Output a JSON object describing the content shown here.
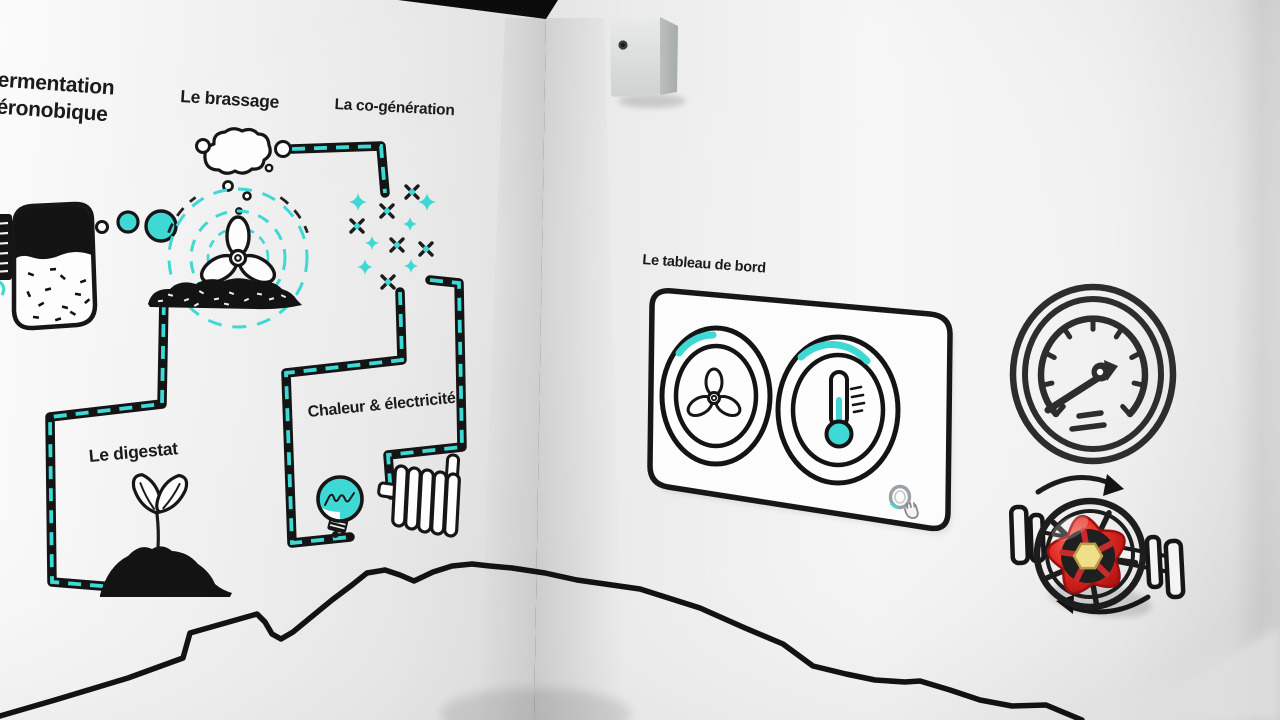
{
  "colors": {
    "accent": "#3ed8d5",
    "ink": "#1b1b1b",
    "valve-red": "#d42222",
    "valve-red-dark": "#9b0f0f",
    "valve-yellow": "#f1de8b",
    "panel-fill": "#fcfcfc",
    "hint-gray": "#9aa0a3"
  },
  "mural": {
    "title_line1": "fermentation",
    "title_line2": "aéronobique",
    "brewing_label": "Le brassage",
    "cogeneration_label": "La co-génération",
    "digestate_label": "Le digestat",
    "heat_electricity_label": "Chaleur & électricité"
  },
  "dashboard": {
    "title": "Le tableau de bord",
    "dials": [
      {
        "name": "fan-dial",
        "icon": "fan-icon",
        "level_indicator": "teal-arc"
      },
      {
        "name": "temperature-dial",
        "icon": "thermometer-icon",
        "level_indicator": "teal-arc"
      }
    ],
    "hint_icon": "magnifier-hand-icon"
  },
  "right_wall_props": {
    "gauge_icon": "pressure-gauge-icon",
    "valve_icon": "valve-handwheel",
    "valve_hint": "rotation-arrows",
    "sensor_box": "wall-sensor-box"
  }
}
